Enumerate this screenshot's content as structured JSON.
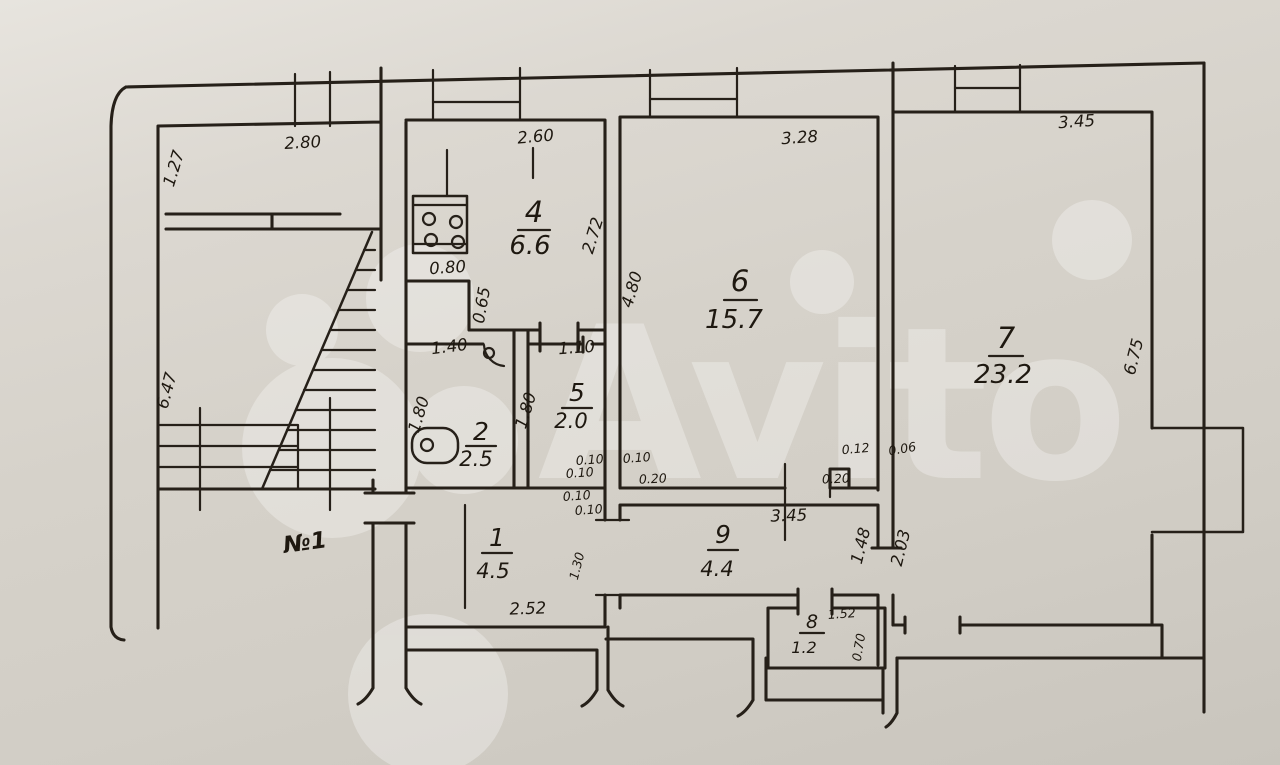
{
  "watermark": {
    "brand": "Avito"
  },
  "plan": {
    "apartment_number": "№1",
    "rooms": [
      {
        "key": "r1",
        "num": "1",
        "area": "4.5"
      },
      {
        "key": "r2",
        "num": "2",
        "area": "2.5"
      },
      {
        "key": "r4",
        "num": "4",
        "area": "6.6"
      },
      {
        "key": "r5",
        "num": "5",
        "area": "2.0"
      },
      {
        "key": "r6",
        "num": "6",
        "area": "15.7"
      },
      {
        "key": "r7",
        "num": "7",
        "area": "23.2"
      },
      {
        "key": "r8",
        "num": "8",
        "area": "1.2"
      },
      {
        "key": "r9",
        "num": "9",
        "area": "4.4"
      }
    ],
    "dims": {
      "stair_top": "2.80",
      "stair_left_top": "1.27",
      "stair_left": "6.47",
      "kitchen_top": "2.60",
      "kitchen_right": "2.72",
      "kitchen_notch_w": "0.80",
      "kitchen_notch_h": "0.65",
      "bath_top": "1.40",
      "bath_left": "1.80",
      "wc_top": "1.10",
      "wc_left": "1.80",
      "r6_top": "3.28",
      "r6_left": "4.80",
      "r7_top": "3.45",
      "r7_right": "6.75",
      "r9_top": "3.45",
      "r9_right": "1.48",
      "r7_niche": "2.03",
      "hall_bottom": "2.52",
      "hall_door": "1.30",
      "r8_top": "1.52",
      "r8_right": "0.70",
      "t1": "0.10",
      "t2": "0.10",
      "t3": "0.10",
      "t4": "0.20",
      "t5": "0.10",
      "t6": "0.10",
      "t7": "0.12",
      "t8": "0.06",
      "t9": "0.20"
    }
  }
}
